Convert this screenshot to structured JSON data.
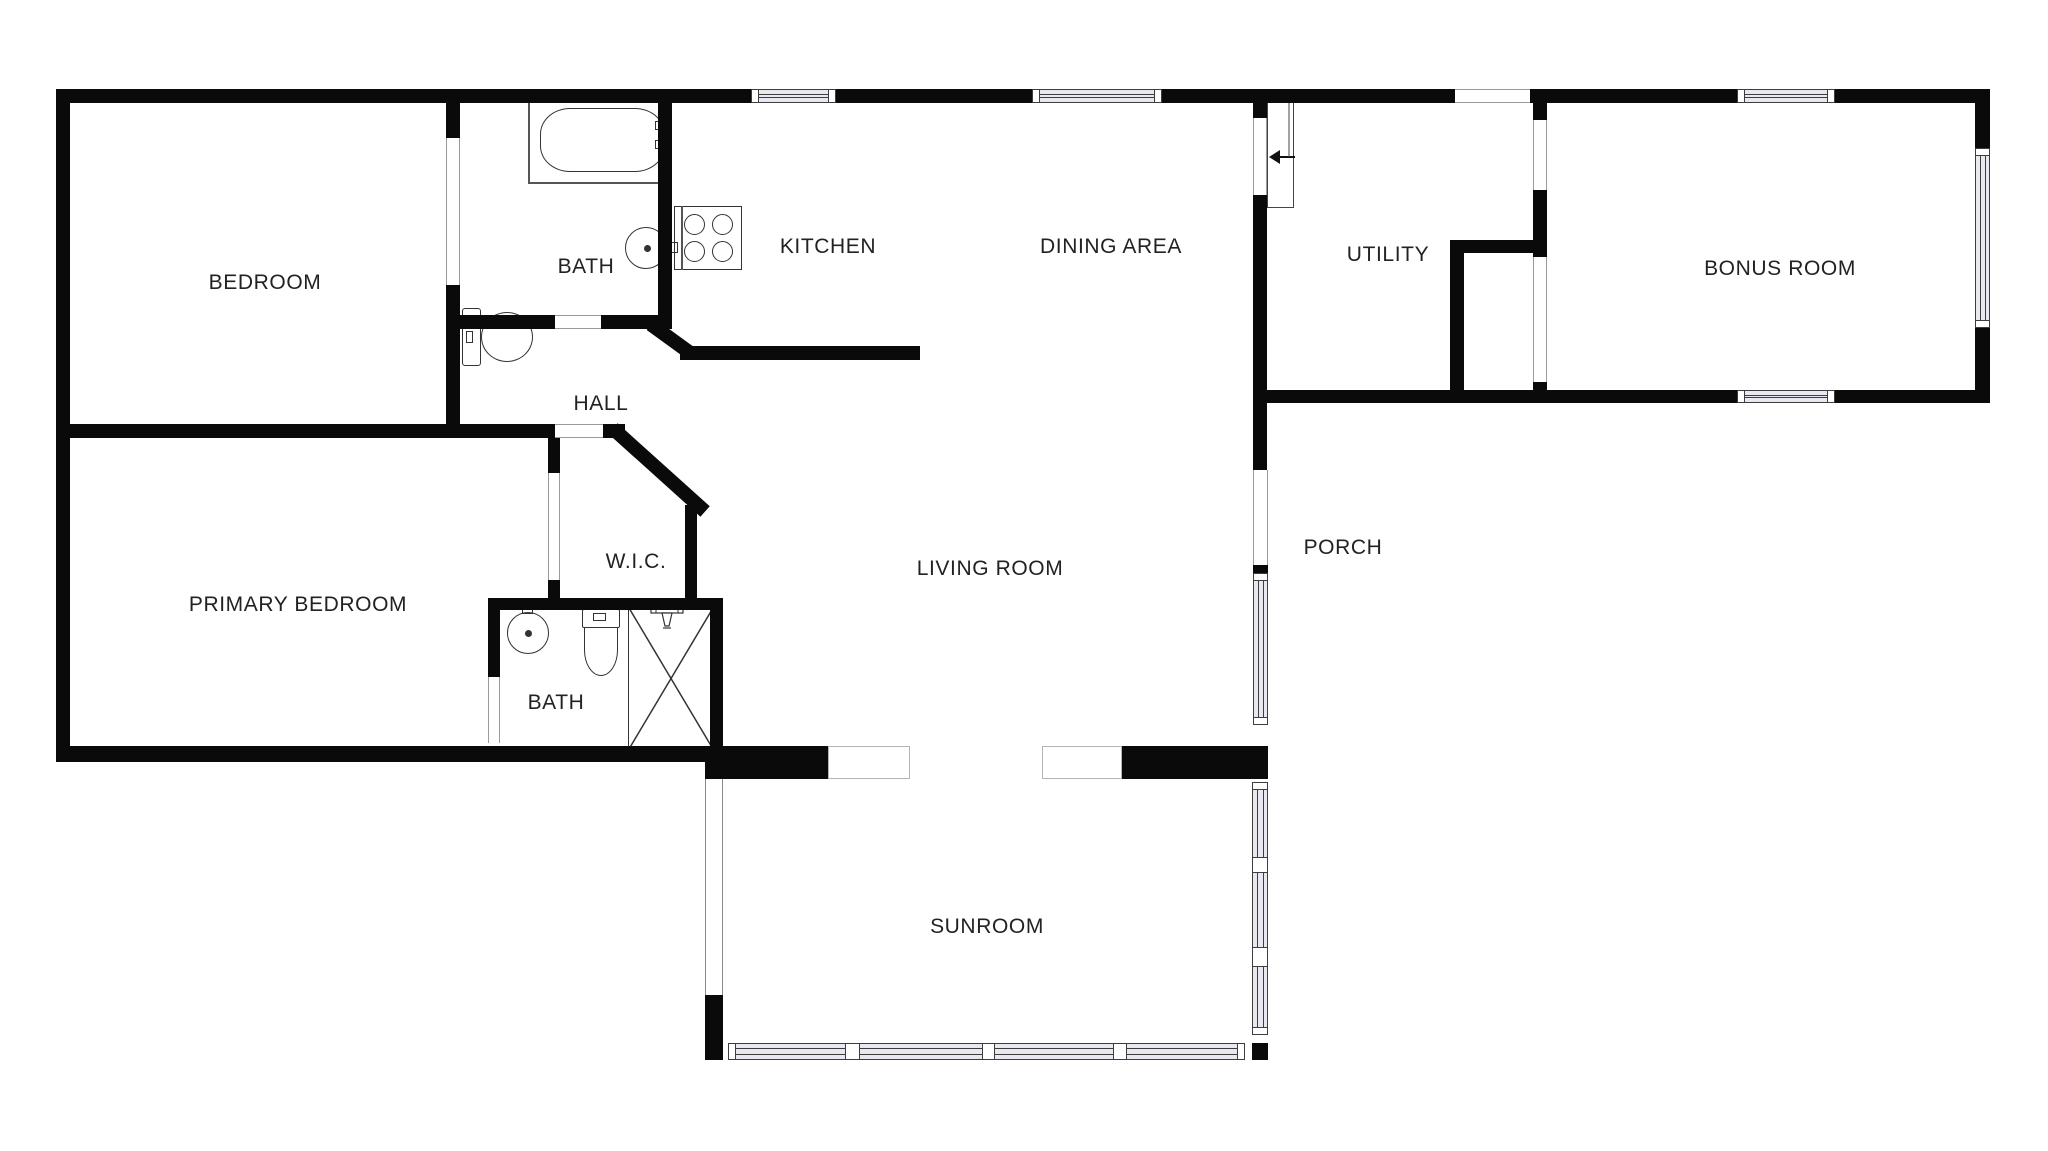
{
  "floorplan": {
    "rooms": [
      {
        "id": "bedroom",
        "label": "BEDROOM"
      },
      {
        "id": "bath-top",
        "label": "BATH"
      },
      {
        "id": "kitchen",
        "label": "KITCHEN"
      },
      {
        "id": "dining-area",
        "label": "DINING AREA"
      },
      {
        "id": "utility",
        "label": "UTILITY"
      },
      {
        "id": "bonus-room",
        "label": "BONUS ROOM"
      },
      {
        "id": "hall",
        "label": "HALL"
      },
      {
        "id": "primary-bedroom",
        "label": "PRIMARY BEDROOM"
      },
      {
        "id": "wic",
        "label": "W.I.C."
      },
      {
        "id": "bath-lower",
        "label": "BATH"
      },
      {
        "id": "living-room",
        "label": "LIVING ROOM"
      },
      {
        "id": "porch",
        "label": "PORCH"
      },
      {
        "id": "sunroom",
        "label": "SUNROOM"
      }
    ],
    "fixtures": [
      "bathtub",
      "toilet",
      "round-sink",
      "stove-4-burners",
      "shower-with-x",
      "staircase",
      "stair-direction-arrow"
    ],
    "colors": {
      "wall": "#0a0a0a",
      "background": "#ffffff",
      "window_fill": "#e9e8f1",
      "outline": "#3d3d3d",
      "text": "#222222"
    }
  }
}
